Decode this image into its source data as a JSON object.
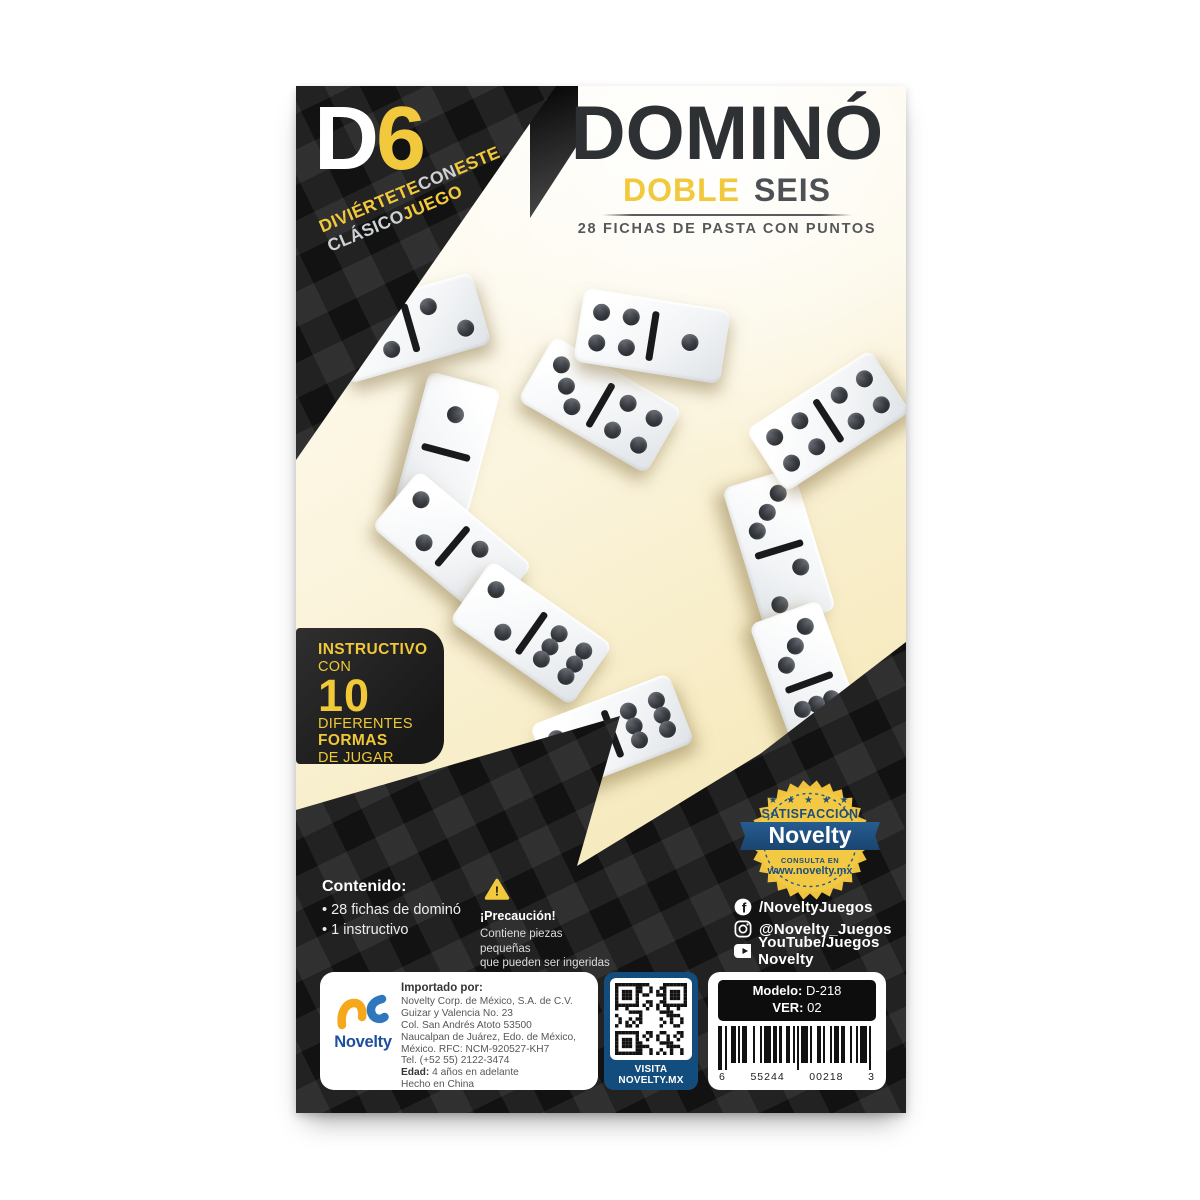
{
  "header": {
    "logo_d": "D",
    "logo_6": "6",
    "tagline_line1": [
      {
        "t": "DIVIÉRTETE",
        "c": "yellow"
      },
      {
        "t": "CON",
        "c": "silver"
      },
      {
        "t": "ESTE",
        "c": "yellow"
      }
    ],
    "tagline_line2": [
      {
        "t": "CLÁSICO",
        "c": "silver"
      },
      {
        "t": "JUEGO",
        "c": "yellow"
      }
    ],
    "title": "DOMINÓ",
    "subtitle_primary": "DOBLE",
    "subtitle_secondary": "SEIS",
    "description": "28 FICHAS DE PASTA CON PUNTOS"
  },
  "instructivo_badge": {
    "lines": [
      {
        "t": "INSTRUCTIVO"
      },
      {
        "t": "CON"
      },
      {
        "t": "10"
      },
      {
        "t": "DIFERENTES"
      },
      {
        "t": "FORMAS"
      },
      {
        "t": "DE JUGAR"
      }
    ]
  },
  "dominoes": [
    {
      "id": "G",
      "cx": 446,
      "cy": 452,
      "rot": 105,
      "v": [
        1,
        0
      ]
    },
    {
      "id": "C",
      "cx": 600,
      "cy": 405,
      "rot": 30,
      "v": [
        3,
        4
      ]
    },
    {
      "id": "H",
      "cx": 452,
      "cy": 546,
      "rot": 40,
      "v": [
        2,
        2
      ]
    },
    {
      "id": "I",
      "cx": 531,
      "cy": 633,
      "rot": 35,
      "v": [
        2,
        6
      ]
    },
    {
      "id": "J",
      "cx": 612,
      "cy": 734,
      "rot": -21,
      "v": [
        3,
        6
      ]
    },
    {
      "id": "E",
      "cx": 779,
      "cy": 549,
      "rot": 73,
      "v": [
        3,
        2
      ]
    },
    {
      "id": "F",
      "cx": 809,
      "cy": 682,
      "rot": 70,
      "v": [
        3,
        6
      ]
    },
    {
      "id": "A",
      "cx": 410,
      "cy": 328,
      "rot": -16,
      "v": [
        2,
        2
      ]
    },
    {
      "id": "B",
      "cx": 652,
      "cy": 336,
      "rot": 9,
      "v": [
        4,
        1
      ]
    },
    {
      "id": "D",
      "cx": 828,
      "cy": 421,
      "rot": -33,
      "v": [
        4,
        4
      ]
    }
  ],
  "seal": {
    "stars": "★ ★ ★ ★ ★",
    "top_word": "SATISFACCIÓN",
    "brand": "Novelty",
    "line1": "CONSULTA EN",
    "line2": "www.novelty.mx"
  },
  "social": {
    "items": [
      {
        "icon": "facebook-icon",
        "handle": "/NoveltyJuegos"
      },
      {
        "icon": "instagram-icon",
        "handle": "@Novelty_Juegos"
      },
      {
        "icon": "youtube-icon",
        "handle": "YouTube/Juegos Novelty"
      }
    ]
  },
  "contenido": {
    "title": "Contenido:",
    "items": [
      "• 28 fichas de dominó",
      "• 1 instructivo"
    ]
  },
  "precaucion": {
    "title": "¡Precaución!",
    "lines": [
      "Contiene piezas pequeñas",
      "que pueden ser ingeridas",
      "y provocar asfixia en niños",
      "menores de 3 años."
    ]
  },
  "importer": {
    "title": "Importado por:",
    "brand": "Novelty",
    "lines": [
      "Novelty Corp. de México, S.A. de C.V.",
      "Guizar y Valencia No. 23",
      "Col. San Andrés Atoto 53500",
      "Naucalpan de Juárez, Edo. de México,",
      "México.  RFC: NCM-920527-KH7",
      "Tel. (+52 55) 2122-3474"
    ],
    "age_label": "Edad:",
    "age_value": " 4 años en adelante",
    "origin": "Hecho en China"
  },
  "qr": {
    "caption": "VISITA NOVELTY.MX"
  },
  "model_box": {
    "model_label": "Modelo:",
    "model_value": " D-218",
    "ver_label": "VER:",
    "ver_value": " 02",
    "barcode_digits": [
      "6",
      "55244",
      "00218",
      "3"
    ]
  },
  "colors": {
    "yellow": "#f2c83c",
    "seal_blue": "#1e4e7c",
    "logo_blue": "#1f4e9c",
    "title_dark": "#2e3134",
    "qr_box_blue": "#134d7e",
    "panel_black": "#161616",
    "cream": "#f2e2a8"
  }
}
